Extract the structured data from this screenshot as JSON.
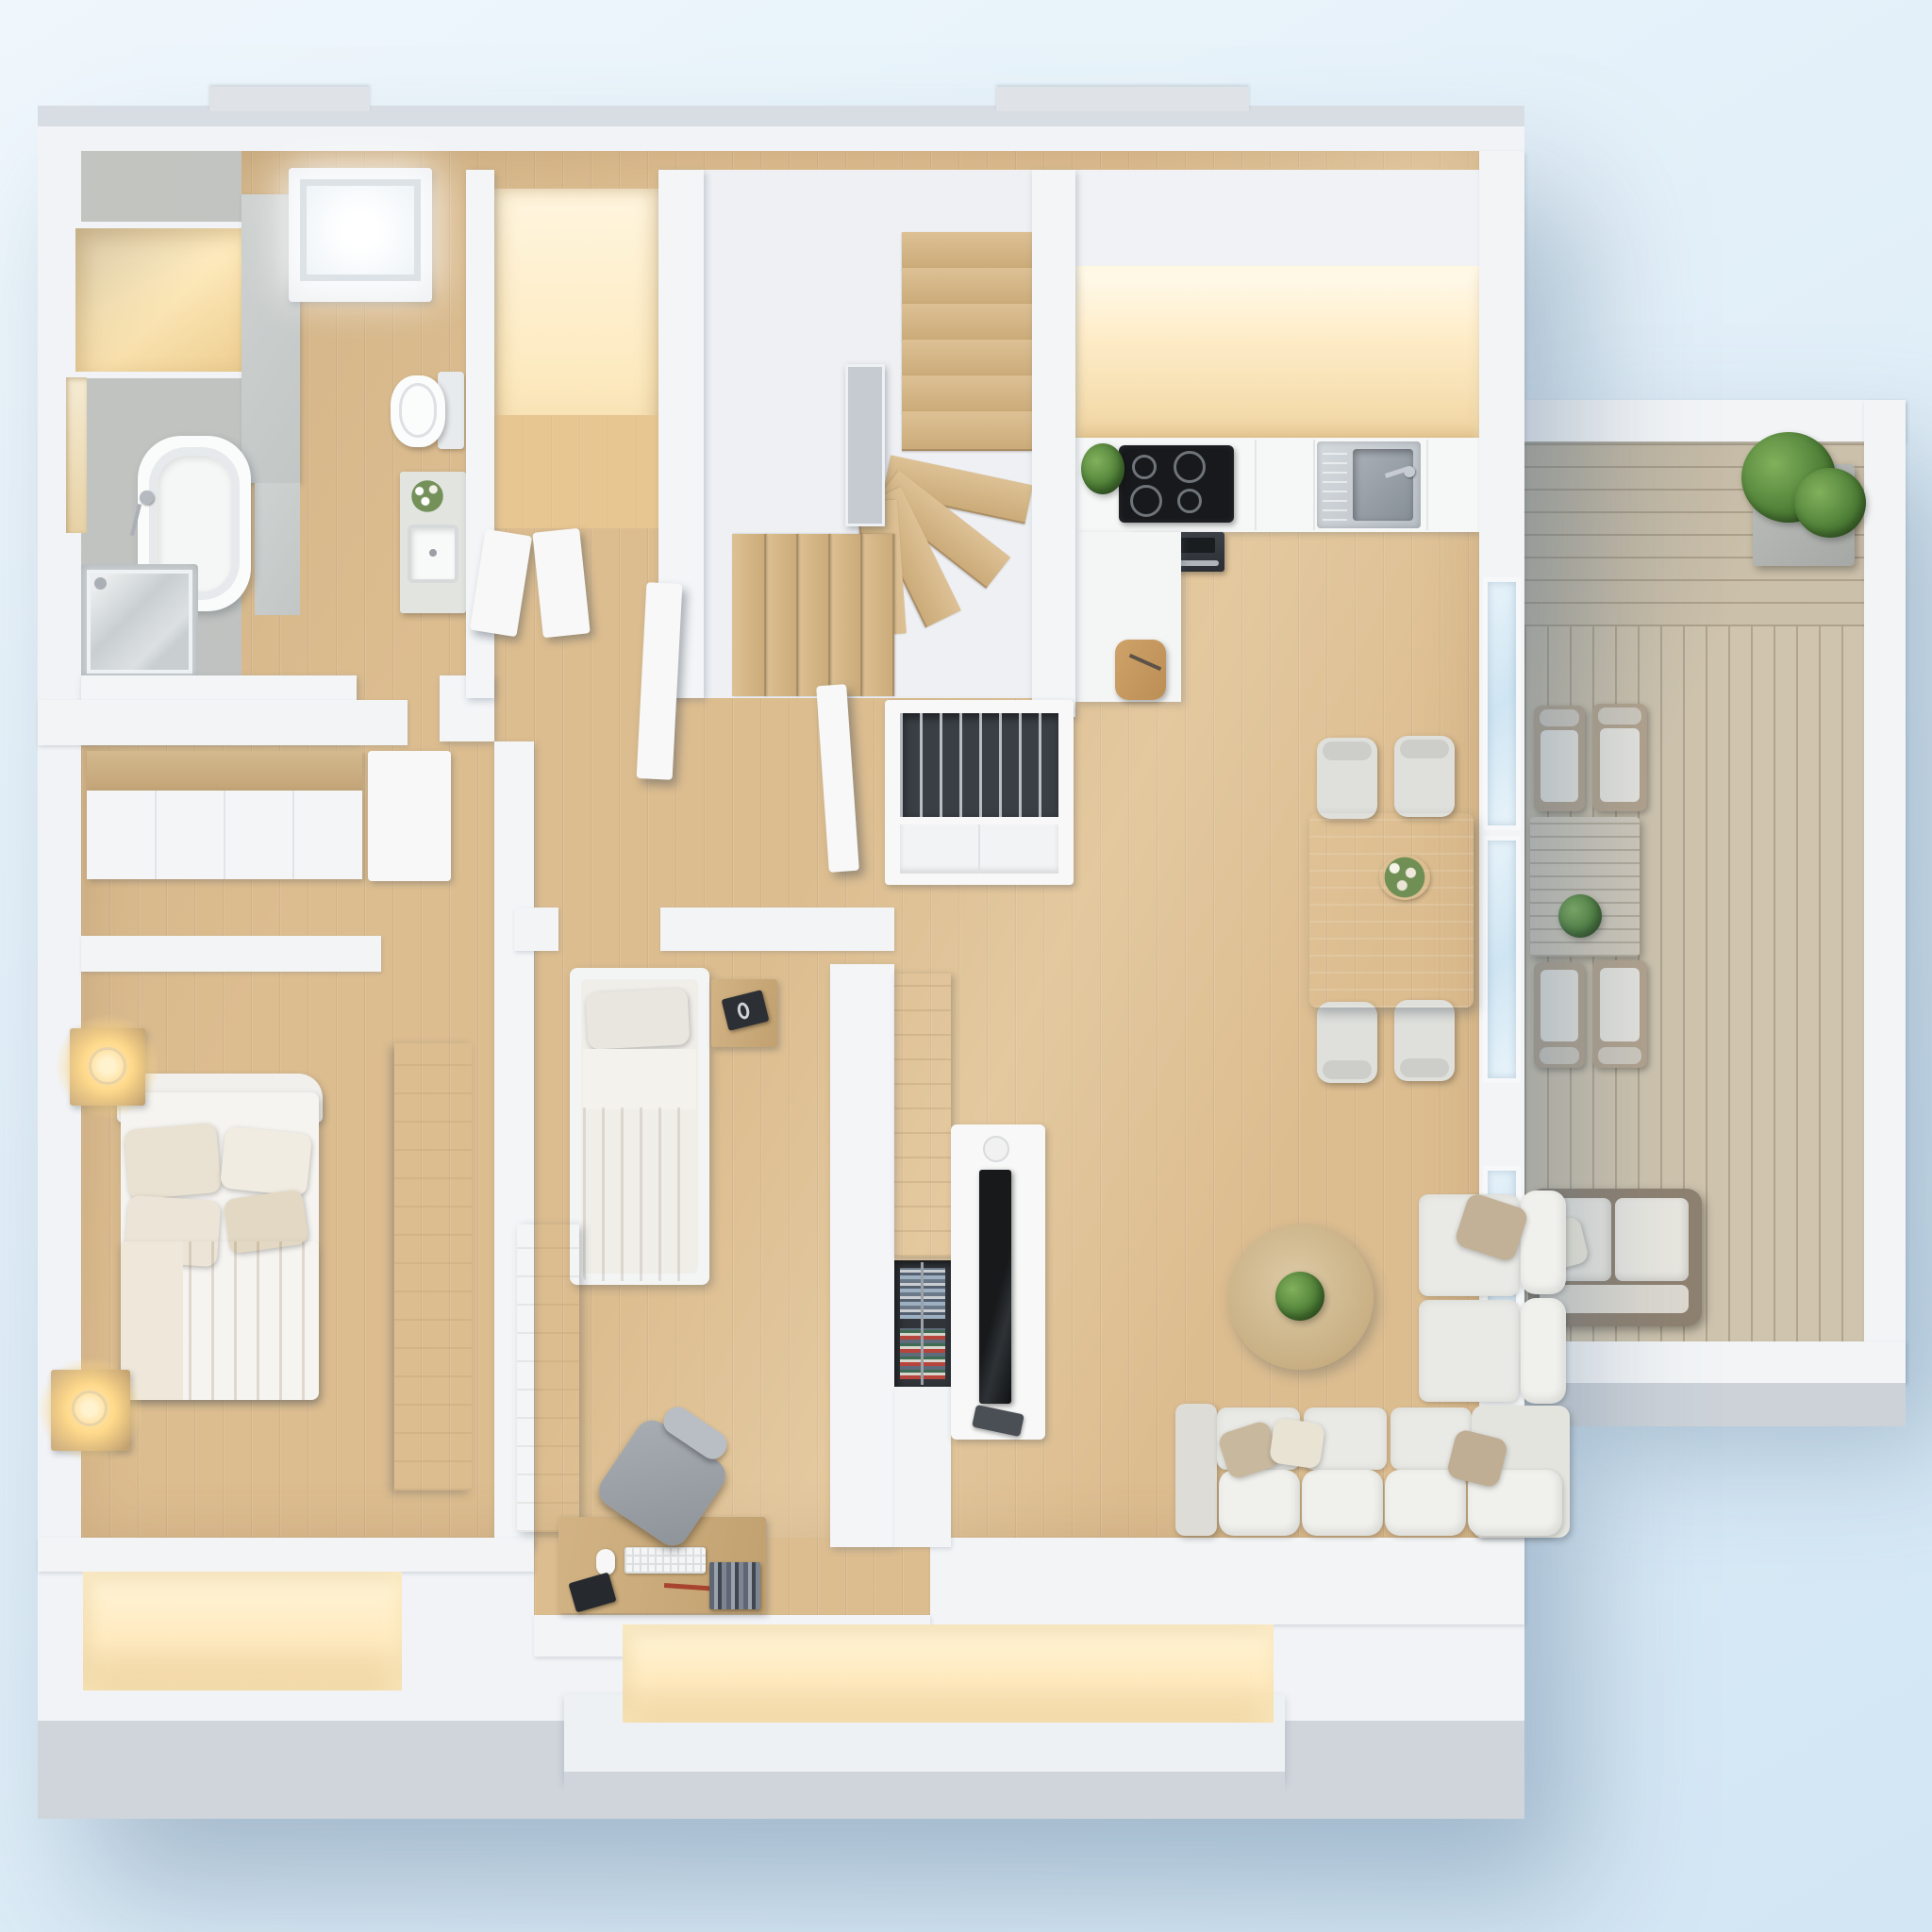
{
  "meta": {
    "image_kind": "3d-floor-plan-render",
    "view": "top-down axonometric",
    "style": "photorealistic white-model archviz with warm accent lighting",
    "background": "soft light-blue studio gradient"
  },
  "palette": {
    "background_top": "#eff7fc",
    "background_bottom": "#d2e6f4",
    "wall_white": "#f3f5f7",
    "wall_shade": "#cfd5db",
    "concrete_gray": "#c8cccb",
    "floor_wood": "#dcbd90",
    "deck_wood": "#cfc4ae",
    "warm_light": "#ffeec6",
    "furniture_white": "#f7f8f7",
    "furniture_wood": "#cbab79",
    "cushion_gray": "#e9e9e5",
    "pillow_tan": "#c2b197",
    "tv_black": "#17191b",
    "plant_green": "#4c7d35",
    "glass_blue": "#d8eaf5"
  },
  "scene": {
    "rooms": [
      {
        "id": "bathroom",
        "name": "Bathroom",
        "furniture": [
          "lit wall niche",
          "bathtub with hand shower",
          "glass shower enclosure",
          "concrete floor"
        ]
      },
      {
        "id": "wc",
        "name": "Toilet room",
        "furniture": [
          "skylight roof window",
          "wall-hung toilet",
          "vanity with square basin and flowers"
        ]
      },
      {
        "id": "closet",
        "name": "Warm-lit closet",
        "furniture": [
          "two open white doors"
        ]
      },
      {
        "id": "stairwell",
        "name": "Winder staircase",
        "furniture": [
          "upper straight flight",
          "quarter-turn fan treads",
          "lower flight",
          "glass balustrade panel"
        ]
      },
      {
        "id": "kitchen",
        "name": "Kitchen",
        "furniture": [
          "warm-lit tall cabinets",
          "worktop",
          "induction cooktop 4 burners",
          "built-in oven",
          "stainless sink with faucet",
          "potted herb",
          "peninsula cabinet",
          "cutting board with knife"
        ]
      },
      {
        "id": "dining",
        "name": "Dining area",
        "furniture": [
          "wooden dining table",
          "flower centerpiece",
          "four gray chairs"
        ]
      },
      {
        "id": "living",
        "name": "Living room",
        "furniture": [
          "L-shaped sectional sofa",
          "five scatter pillows",
          "round wooden coffee table with plant",
          "white TV lowboard",
          "flat TV",
          "speaker",
          "media remote",
          "divider wood cabinet",
          "book shelf with magazines"
        ]
      },
      {
        "id": "hallway",
        "name": "Entry hallway",
        "furniture": [
          "open double doors",
          "white console sideboard with slatted tray"
        ]
      },
      {
        "id": "master-bedroom",
        "name": "Master bedroom",
        "furniture": [
          "double bed with beige duvet",
          "four pillows",
          "two wooden nightstands",
          "two glowing table lamps",
          "sliding-door wardrobe",
          "tall side wardrobe",
          "lit window niche"
        ]
      },
      {
        "id": "kids-room",
        "name": "Kids room / study",
        "furniture": [
          "single bed",
          "wooden nightstand with book",
          "wardrobe",
          "desk with keyboard, mouse, books and notebook",
          "gray desk chair"
        ]
      },
      {
        "id": "balcony",
        "name": "Balcony terrace",
        "furniture": [
          "wood decking",
          "planter box with shrub",
          "slatted outdoor table with potted plant",
          "four cushioned armchairs",
          "rattan loveseat with pillow",
          "glass sliding doors"
        ]
      }
    ],
    "lighting": [
      "warm cove light in bathroom niche",
      "warm light in closet",
      "warm cove light over kitchen wall",
      "two bedside lamp glows",
      "two warm window niches at bottom facade",
      "skylight daylight glow"
    ]
  }
}
